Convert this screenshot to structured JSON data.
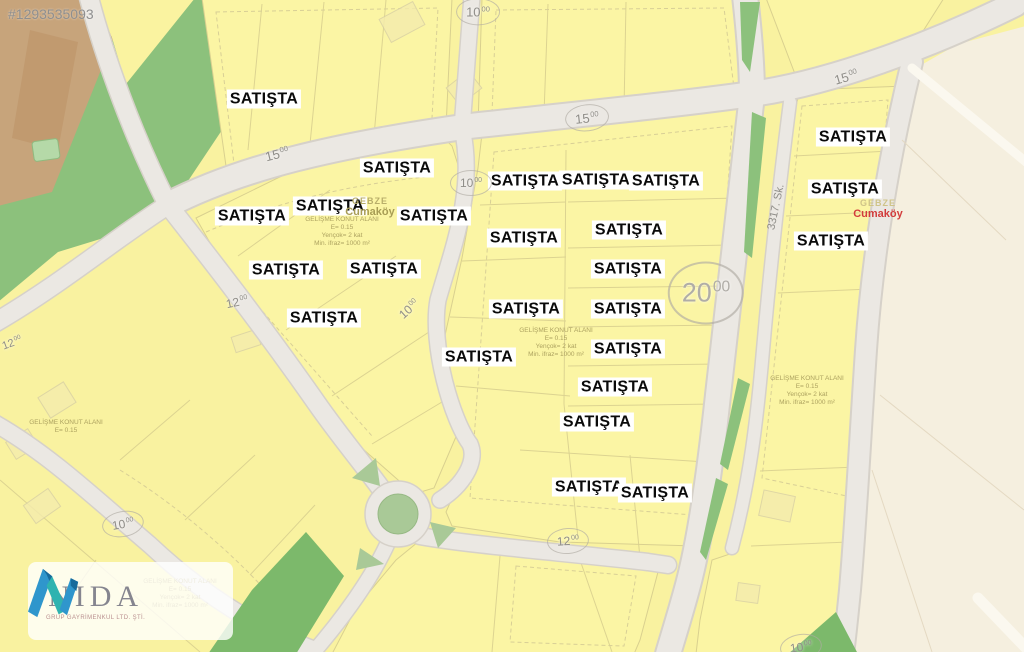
{
  "watermark": "#1293535093",
  "logo": {
    "name": "NIDA",
    "tagline": "GRUP GAYRİMENKUL LTD. ŞTİ."
  },
  "map": {
    "sale_label": "SATIŞTA",
    "sale_positions": [
      {
        "x": 264,
        "y": 99
      },
      {
        "x": 397,
        "y": 168
      },
      {
        "x": 330,
        "y": 206
      },
      {
        "x": 252,
        "y": 216
      },
      {
        "x": 434,
        "y": 216
      },
      {
        "x": 286,
        "y": 270
      },
      {
        "x": 384,
        "y": 269
      },
      {
        "x": 324,
        "y": 318
      },
      {
        "x": 479,
        "y": 357
      },
      {
        "x": 525,
        "y": 181
      },
      {
        "x": 596,
        "y": 180
      },
      {
        "x": 666,
        "y": 181
      },
      {
        "x": 524,
        "y": 238
      },
      {
        "x": 629,
        "y": 230
      },
      {
        "x": 628,
        "y": 269
      },
      {
        "x": 526,
        "y": 309
      },
      {
        "x": 628,
        "y": 309
      },
      {
        "x": 628,
        "y": 349
      },
      {
        "x": 615,
        "y": 387
      },
      {
        "x": 597,
        "y": 422
      },
      {
        "x": 589,
        "y": 487
      },
      {
        "x": 655,
        "y": 493
      },
      {
        "x": 853,
        "y": 137
      },
      {
        "x": 845,
        "y": 189
      },
      {
        "x": 831,
        "y": 241
      }
    ],
    "road_labels": [
      {
        "num": "10",
        "sup": "00",
        "x": 478,
        "y": 12,
        "rot": 0,
        "size": 13,
        "circ": true,
        "big": false
      },
      {
        "num": "15",
        "sup": "00",
        "x": 277,
        "y": 154,
        "rot": -14,
        "size": 13,
        "circ": false,
        "big": false
      },
      {
        "num": "15",
        "sup": "00",
        "x": 587,
        "y": 118,
        "rot": -6,
        "size": 13,
        "circ": true,
        "big": false
      },
      {
        "num": "15",
        "sup": "00",
        "x": 846,
        "y": 77,
        "rot": -16,
        "size": 13,
        "circ": false,
        "big": false
      },
      {
        "num": "10",
        "sup": "00",
        "x": 471,
        "y": 183,
        "rot": 0,
        "size": 12,
        "circ": true,
        "big": false
      },
      {
        "num": "10",
        "sup": "00",
        "x": 409,
        "y": 309,
        "rot": -42,
        "size": 12,
        "circ": false,
        "big": false
      },
      {
        "num": "12",
        "sup": "00",
        "x": 237,
        "y": 302,
        "rot": -12,
        "size": 12,
        "circ": false,
        "big": false
      },
      {
        "num": "12",
        "sup": "00",
        "x": 568,
        "y": 541,
        "rot": -4,
        "size": 12,
        "circ": true,
        "big": false
      },
      {
        "num": "10",
        "sup": "00",
        "x": 123,
        "y": 524,
        "rot": -10,
        "size": 12,
        "circ": true,
        "big": false
      },
      {
        "num": "12",
        "sup": "00",
        "x": 12,
        "y": 343,
        "rot": -20,
        "size": 11,
        "circ": false,
        "big": false
      },
      {
        "num": "20",
        "sup": "00",
        "x": 706,
        "y": 293,
        "rot": 0,
        "size": 27,
        "circ": true,
        "big": true
      },
      {
        "num": "10",
        "sup": "00",
        "x": 801,
        "y": 647,
        "rot": -8,
        "size": 12,
        "circ": true,
        "big": false
      }
    ],
    "street_label": {
      "text": "3317. Sk.",
      "x": 776,
      "y": 207,
      "rot": -78
    },
    "place_labels": [
      {
        "top": "GEBZE",
        "sub": "Cumaköy",
        "x": 370,
        "y": 207,
        "top_color": "#b8ae6a",
        "sub_color": "#a89d55"
      },
      {
        "top": "GEBZE",
        "sub": "Cumaköy",
        "x": 878,
        "y": 209,
        "top_color": "#cfc489",
        "sub_color": "#d23c3c"
      }
    ],
    "zone_blocks": [
      {
        "x": 342,
        "y": 232,
        "lines": [
          "GELİŞME KONUT ALANI",
          "E= 0.15",
          "Yençok= 2 kat",
          "Min. ifraz= 1000 m²"
        ]
      },
      {
        "x": 556,
        "y": 343,
        "lines": [
          "GELİŞME KONUT ALANI",
          "E= 0.15",
          "Yençok= 2 kat",
          "Min. ifraz= 1000 m²"
        ]
      },
      {
        "x": 66,
        "y": 427,
        "lines": [
          "GELİŞME KONUT ALANI",
          "E= 0.15"
        ]
      },
      {
        "x": 807,
        "y": 391,
        "lines": [
          "GELİŞME KONUT ALANI",
          "E= 0.15",
          "Yençok= 2 kat",
          "Min. ifraz= 1000 m²"
        ]
      },
      {
        "x": 180,
        "y": 594,
        "lines": [
          "GELİŞME KONUT ALANI",
          "E= 0.15",
          "Yençok= 2 kat",
          "Min. ifraz= 1000 m²"
        ]
      }
    ],
    "colors": {
      "parcel_yellow": "#faf3a0",
      "road_gray": "#ebe8e3",
      "green": "#8cc17c",
      "dark_green": "#7cb96b",
      "beige": "#f5efdf",
      "brown": "#c7a47b",
      "sale_red": "#d23c3c"
    }
  }
}
